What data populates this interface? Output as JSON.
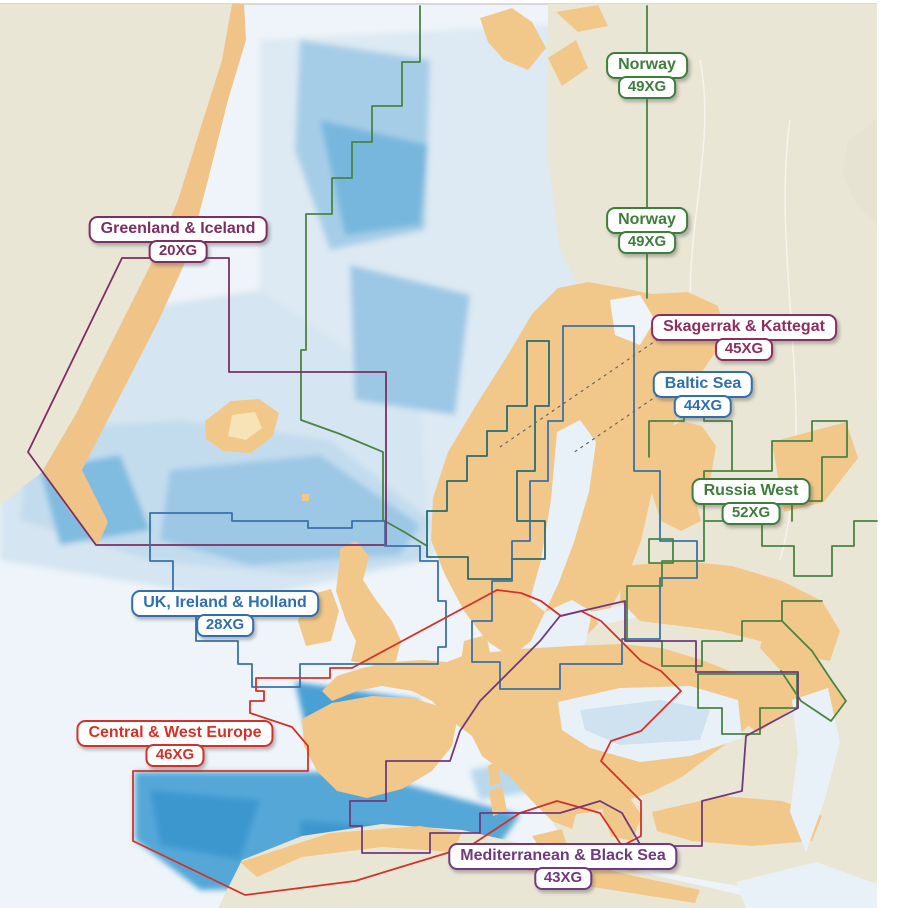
{
  "map": {
    "description": "Europe nautical chart coverage map with bathymetric shading",
    "regions": [
      {
        "id": "norway-upper",
        "name": "Norway",
        "code": "49XG",
        "color": "#3f7d3c"
      },
      {
        "id": "norway-lower",
        "name": "Norway",
        "code": "49XG",
        "color": "#3f7d3c"
      },
      {
        "id": "greenland-iceland",
        "name": "Greenland & Iceland",
        "code": "20XG",
        "color": "#7d2e62"
      },
      {
        "id": "skagerrak-kattegat",
        "name": "Skagerrak & Kattegat",
        "code": "45XG",
        "color": "#8c2f5e"
      },
      {
        "id": "baltic-sea",
        "name": "Baltic Sea",
        "code": "44XG",
        "color": "#2f6fad"
      },
      {
        "id": "russia-west",
        "name": "Russia West",
        "code": "52XG",
        "color": "#3f7d3c"
      },
      {
        "id": "uk-ireland-holland",
        "name": "UK, Ireland & Holland",
        "code": "28XG",
        "color": "#2f6fad"
      },
      {
        "id": "central-west-europe",
        "name": "Central & West Europe",
        "code": "46XG",
        "color": "#d2322a"
      },
      {
        "id": "mediterranean-black-sea",
        "name": "Mediterranean & Black Sea",
        "code": "43XG",
        "color": "#6f3a7f"
      }
    ],
    "map_colors": {
      "sea_pale": "#eef4f9",
      "sea_shelf": "#c2dcee",
      "sea_medium": "#9cc8e5",
      "sea_deep": "#54a7d8",
      "land_tan": "#f2c88a",
      "land_beige": "#eae6d5",
      "leader_line": "#666666"
    }
  }
}
